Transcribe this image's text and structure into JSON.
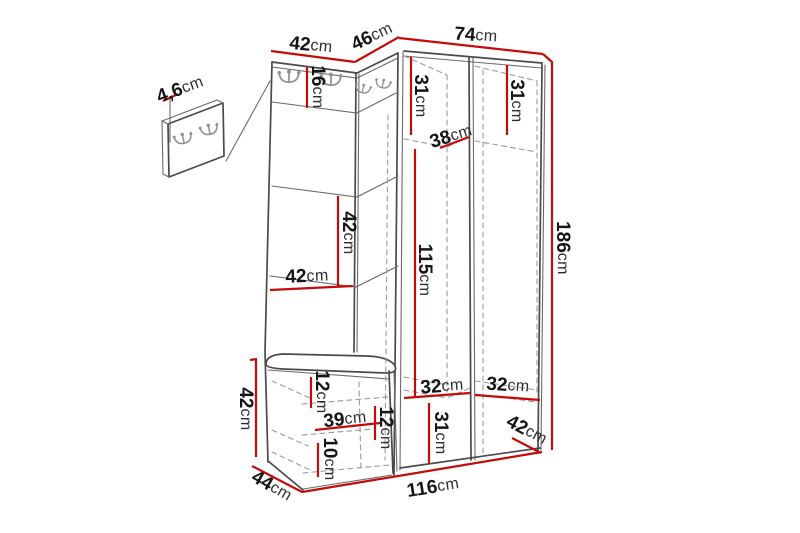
{
  "diagram": {
    "type": "furniture-dimension-diagram",
    "subject": "corner hallway unit with coat hooks, wardrobe and shoe bench",
    "unit": "cm",
    "colors": {
      "background": "#ffffff",
      "measurement_line": "#c40b0b",
      "outline": "#4a4a4a",
      "hidden_edge": "#9b9b9b",
      "hook": "#8f8f8f",
      "label_text": "#151515"
    },
    "dims": {
      "panel_thickness": {
        "value": "4,6",
        "unit": "cm"
      },
      "hook_panel_width": {
        "value": "42",
        "unit": "cm"
      },
      "corner_width": {
        "value": "46",
        "unit": "cm"
      },
      "wardrobe_width": {
        "value": "74",
        "unit": "cm"
      },
      "hook_strip_height": {
        "value": "16",
        "unit": "cm"
      },
      "left_door_top_height": {
        "value": "31",
        "unit": "cm"
      },
      "right_door_top_height": {
        "value": "31",
        "unit": "cm"
      },
      "wardrobe_depth": {
        "value": "38",
        "unit": "cm"
      },
      "hanging_space_height": {
        "value": "115",
        "unit": "cm"
      },
      "total_height": {
        "value": "186",
        "unit": "cm"
      },
      "open_shelf_height": {
        "value": "42",
        "unit": "cm"
      },
      "open_shelf_width": {
        "value": "42",
        "unit": "cm"
      },
      "bench_height": {
        "value": "42",
        "unit": "cm"
      },
      "bench_top_gap": {
        "value": "12",
        "unit": "cm"
      },
      "bench_inner_width": {
        "value": "39",
        "unit": "cm"
      },
      "bench_mid_gap": {
        "value": "12",
        "unit": "cm"
      },
      "bench_bottom_gap": {
        "value": "10",
        "unit": "cm"
      },
      "bench_depth": {
        "value": "44",
        "unit": "cm"
      },
      "total_width": {
        "value": "116",
        "unit": "cm"
      },
      "left_door_inner_width": {
        "value": "32",
        "unit": "cm"
      },
      "right_door_inner_width": {
        "value": "32",
        "unit": "cm"
      },
      "bottom_compartment_height": {
        "value": "31",
        "unit": "cm"
      },
      "right_bottom_depth": {
        "value": "42",
        "unit": "cm"
      }
    }
  }
}
